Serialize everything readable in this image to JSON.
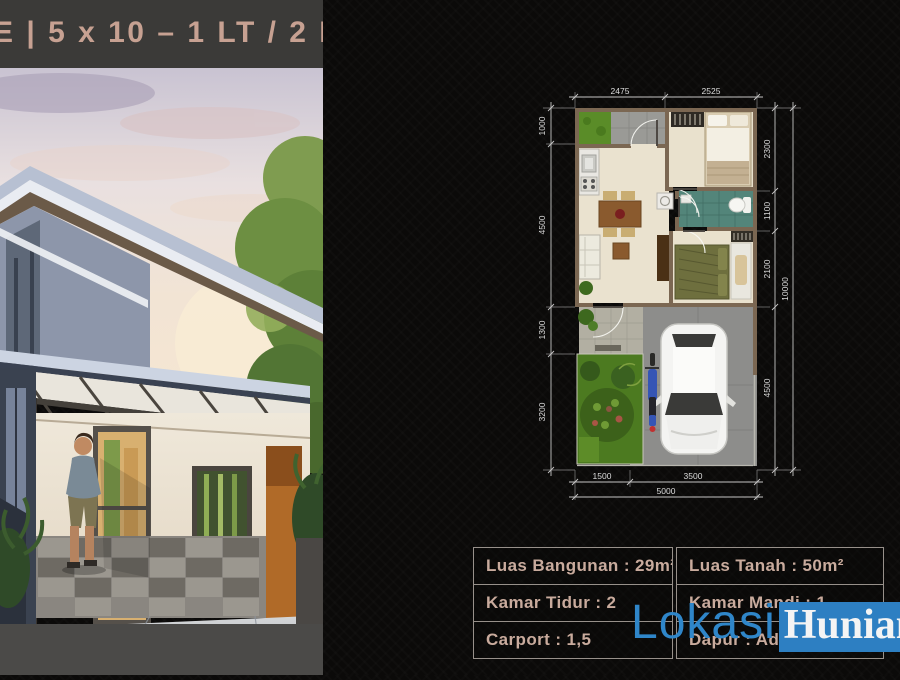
{
  "header": {
    "title": "E | 5 x 10 – 1 LT / 2 KT"
  },
  "floor_plan": {
    "dim_top": [
      "2475",
      "2525"
    ],
    "dim_left": [
      "1000",
      "4500",
      "1300",
      "3200"
    ],
    "dim_right": [
      "2300",
      "1100",
      "2100",
      "4500"
    ],
    "dim_right_total": "10000",
    "dim_bottom": [
      "1500",
      "3500"
    ],
    "dim_bottom_total": "5000"
  },
  "specs": {
    "rows_left": [
      "Luas Bangunan : 29m²",
      "Kamar Tidur : 2",
      "Carport : 1,5"
    ],
    "rows_right": [
      "Luas Tanah : 50m²",
      "Kamar Mandi : 1",
      "Dapur : Ada"
    ]
  },
  "watermark": {
    "lokasi": "Lokasi",
    "hunian": "Hunian"
  },
  "colors": {
    "header_bg": "#3b3a38",
    "header_text": "#c7a192",
    "spec_text": "#c9ab9d",
    "watermark_blue": "#2d7fc2",
    "plan_wall": "#7b6752",
    "plan_floor": "#eae2cf",
    "bathroom_tile": "#53857a",
    "garden_green": "#4c7a20"
  }
}
